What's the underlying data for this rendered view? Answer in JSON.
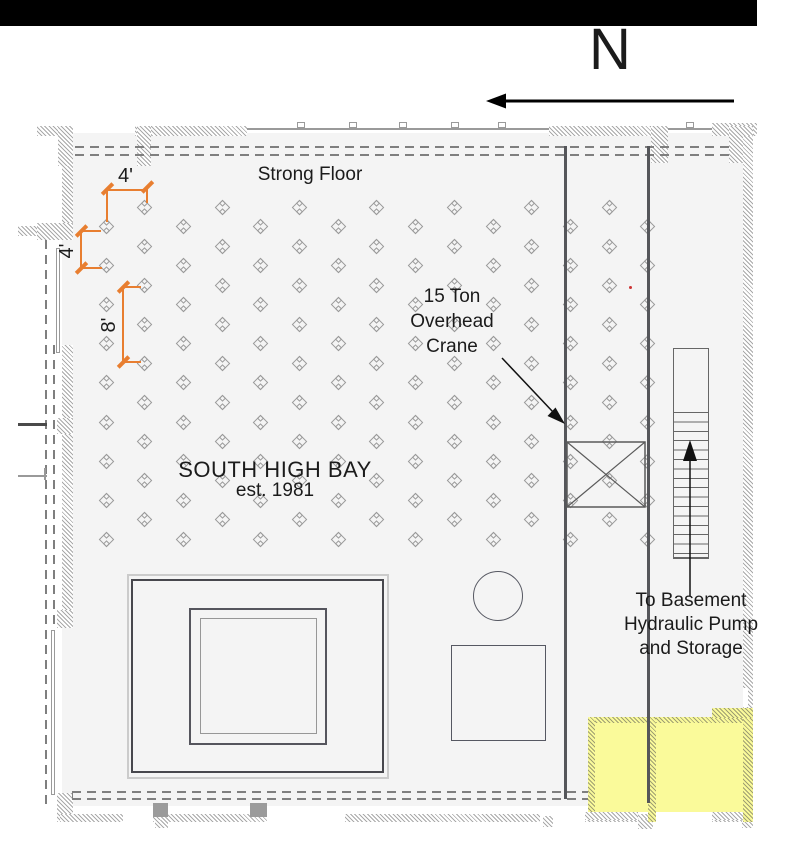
{
  "compass": {
    "label": "N"
  },
  "labels": {
    "strong_floor": "Strong Floor",
    "bay_title": "SOUTH HIGH BAY",
    "bay_subtitle": "est. 1981",
    "crane": [
      "15 Ton",
      "Overhead",
      "Crane"
    ],
    "basement": [
      "To Basement",
      "Hydraulic Pump",
      "and Storage"
    ]
  },
  "dimensions": {
    "spacing_horizontal": "4'",
    "spacing_vertical": "4'",
    "spacing_double": "8'"
  },
  "tie_down_grid": {
    "x0": 107,
    "y0": 208,
    "dx": 38.7,
    "dy": 19.55,
    "cols": 15,
    "rows": 18,
    "rule": "i+j odd"
  },
  "colors": {
    "accent_orange": "#E87E30",
    "highlight_yellow": "#FAFA9A",
    "rail_gray": "#55565A",
    "floor_gray": "#F4F4F4",
    "hatch_gray": "#A9A9A9",
    "text": "#1B1B1B"
  }
}
